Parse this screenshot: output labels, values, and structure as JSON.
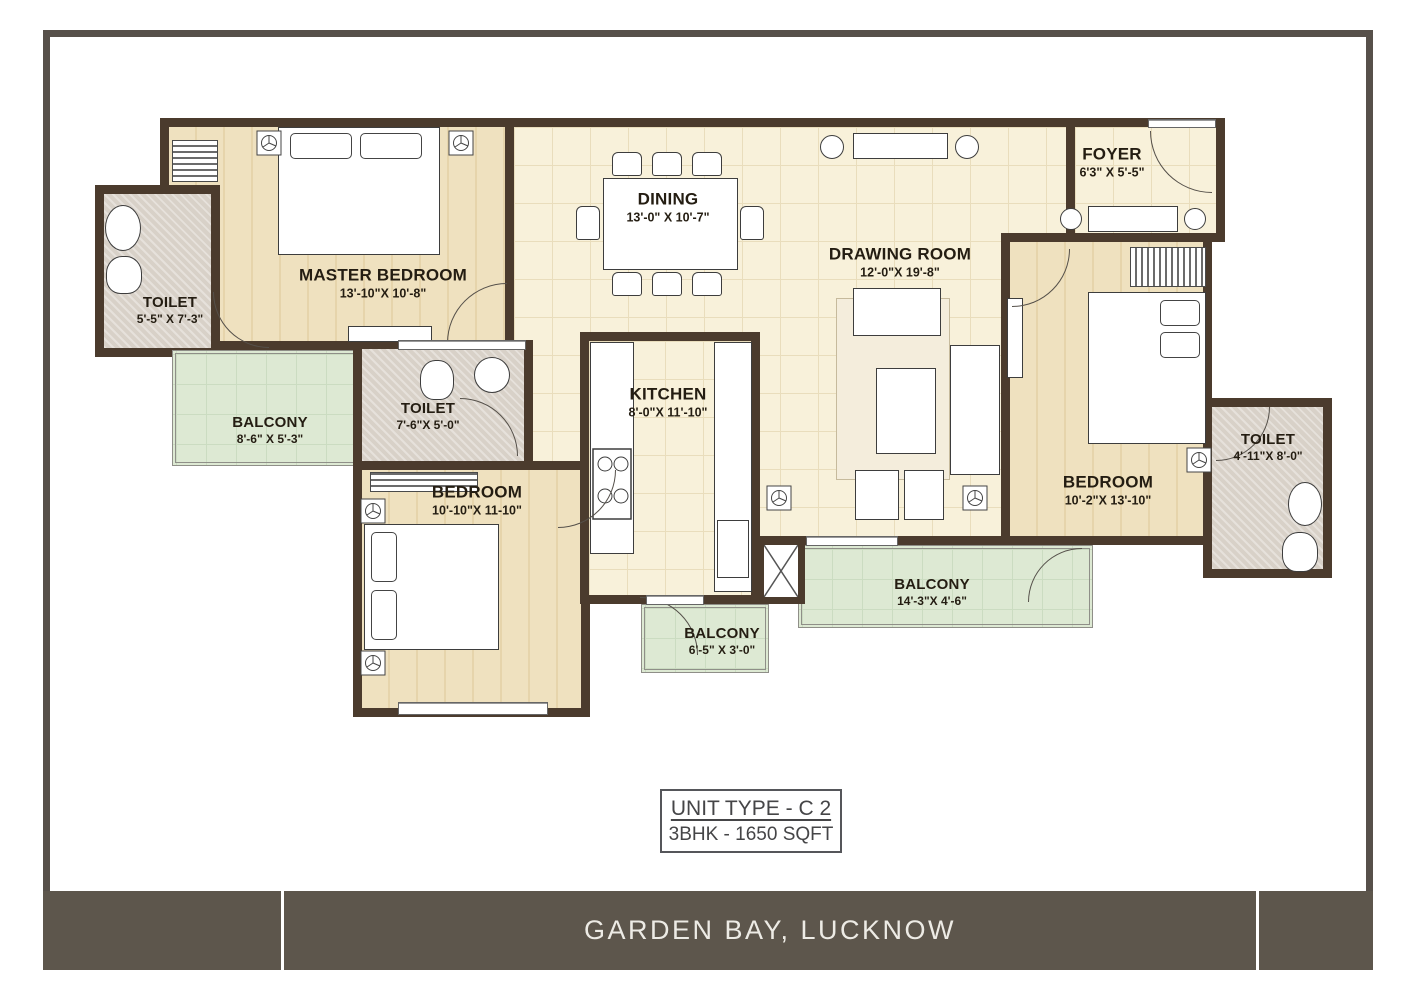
{
  "page": {
    "title_box": {
      "line1": "UNIT TYPE - C 2",
      "line2": "3BHK - 1650 SQFT"
    },
    "footer": {
      "text": "GARDEN BAY, LUCKNOW"
    }
  },
  "colors": {
    "wall": "#4b3b2d",
    "frame": "#57504a",
    "footer_bar": "#5d564c",
    "floor_tile": "#f8f1da",
    "floor_plank": "#efe1bf",
    "balcony": "#dde9d3",
    "toilet_floor": "#d8d1c8"
  },
  "rooms": [
    {
      "id": "master-bedroom",
      "label": "MASTER BEDROOM",
      "dims": "13'-10\"X 10'-8\""
    },
    {
      "id": "toilet-master",
      "label": "TOILET",
      "dims": "5'-5\" X 7'-3\""
    },
    {
      "id": "balcony-master",
      "label": "BALCONY",
      "dims": "8'-6\" X 5'-3\""
    },
    {
      "id": "toilet-2",
      "label": "TOILET",
      "dims": "7'-6\"X 5'-0\""
    },
    {
      "id": "bedroom-2",
      "label": "BEDROOM",
      "dims": "10'-10\"X 11-10\""
    },
    {
      "id": "dining",
      "label": "DINING",
      "dims": "13'-0\" X 10'-7\""
    },
    {
      "id": "kitchen",
      "label": "KITCHEN",
      "dims": "8'-0\"X 11'-10\""
    },
    {
      "id": "drawing-room",
      "label": "DRAWING ROOM",
      "dims": "12'-0\"X 19'-8\""
    },
    {
      "id": "foyer",
      "label": "FOYER",
      "dims": "6'3\" X 5'-5\""
    },
    {
      "id": "bedroom-3",
      "label": "BEDROOM",
      "dims": "10'-2\"X 13'-10\""
    },
    {
      "id": "toilet-3",
      "label": "TOILET",
      "dims": "4'-11\"X 8'-0\""
    },
    {
      "id": "balcony-rear",
      "label": "BALCONY",
      "dims": "14'-3\"X 4'-6\""
    },
    {
      "id": "balcony-kitchen",
      "label": "BALCONY",
      "dims": "6'-5\" X 3'-0\""
    }
  ]
}
